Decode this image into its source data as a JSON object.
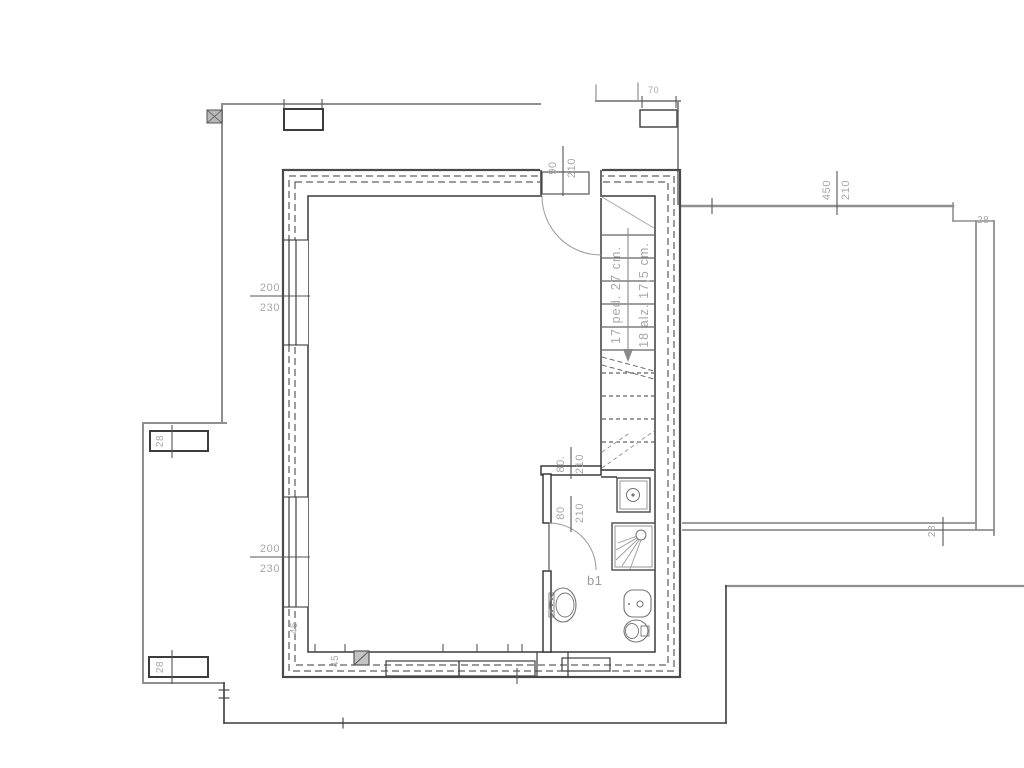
{
  "drawing": {
    "type": "architectural-floor-plan",
    "room_label": "b1",
    "colors": {
      "line_dark": "#3c3c3c",
      "line_gray": "#8f8f8f",
      "dim_text": "#a8a8a8"
    },
    "dimensions": {
      "entry_door": {
        "width": "90",
        "height": "210"
      },
      "terrace_opening": {
        "width": "450",
        "height": "210"
      },
      "window_upper_left": {
        "width": "200",
        "height": "230"
      },
      "window_lower_left": {
        "width": "200",
        "height": "230"
      },
      "bath_opening_upper": {
        "width": "80.",
        "height": "210"
      },
      "bath_door": {
        "width": "80",
        "height": "210"
      },
      "wall_28_terrace_top": "28",
      "wall_28_terrace_bottom": "28",
      "pier_28_upper": "28",
      "pier_28_lower": "28",
      "wall_45_corner": "45",
      "wall_45_bottom": "45",
      "dim_70_top": "70"
    },
    "stair_note": {
      "treads": "17 ped. 27 cm.",
      "risers": "18 alz. 17,5 cm."
    }
  }
}
